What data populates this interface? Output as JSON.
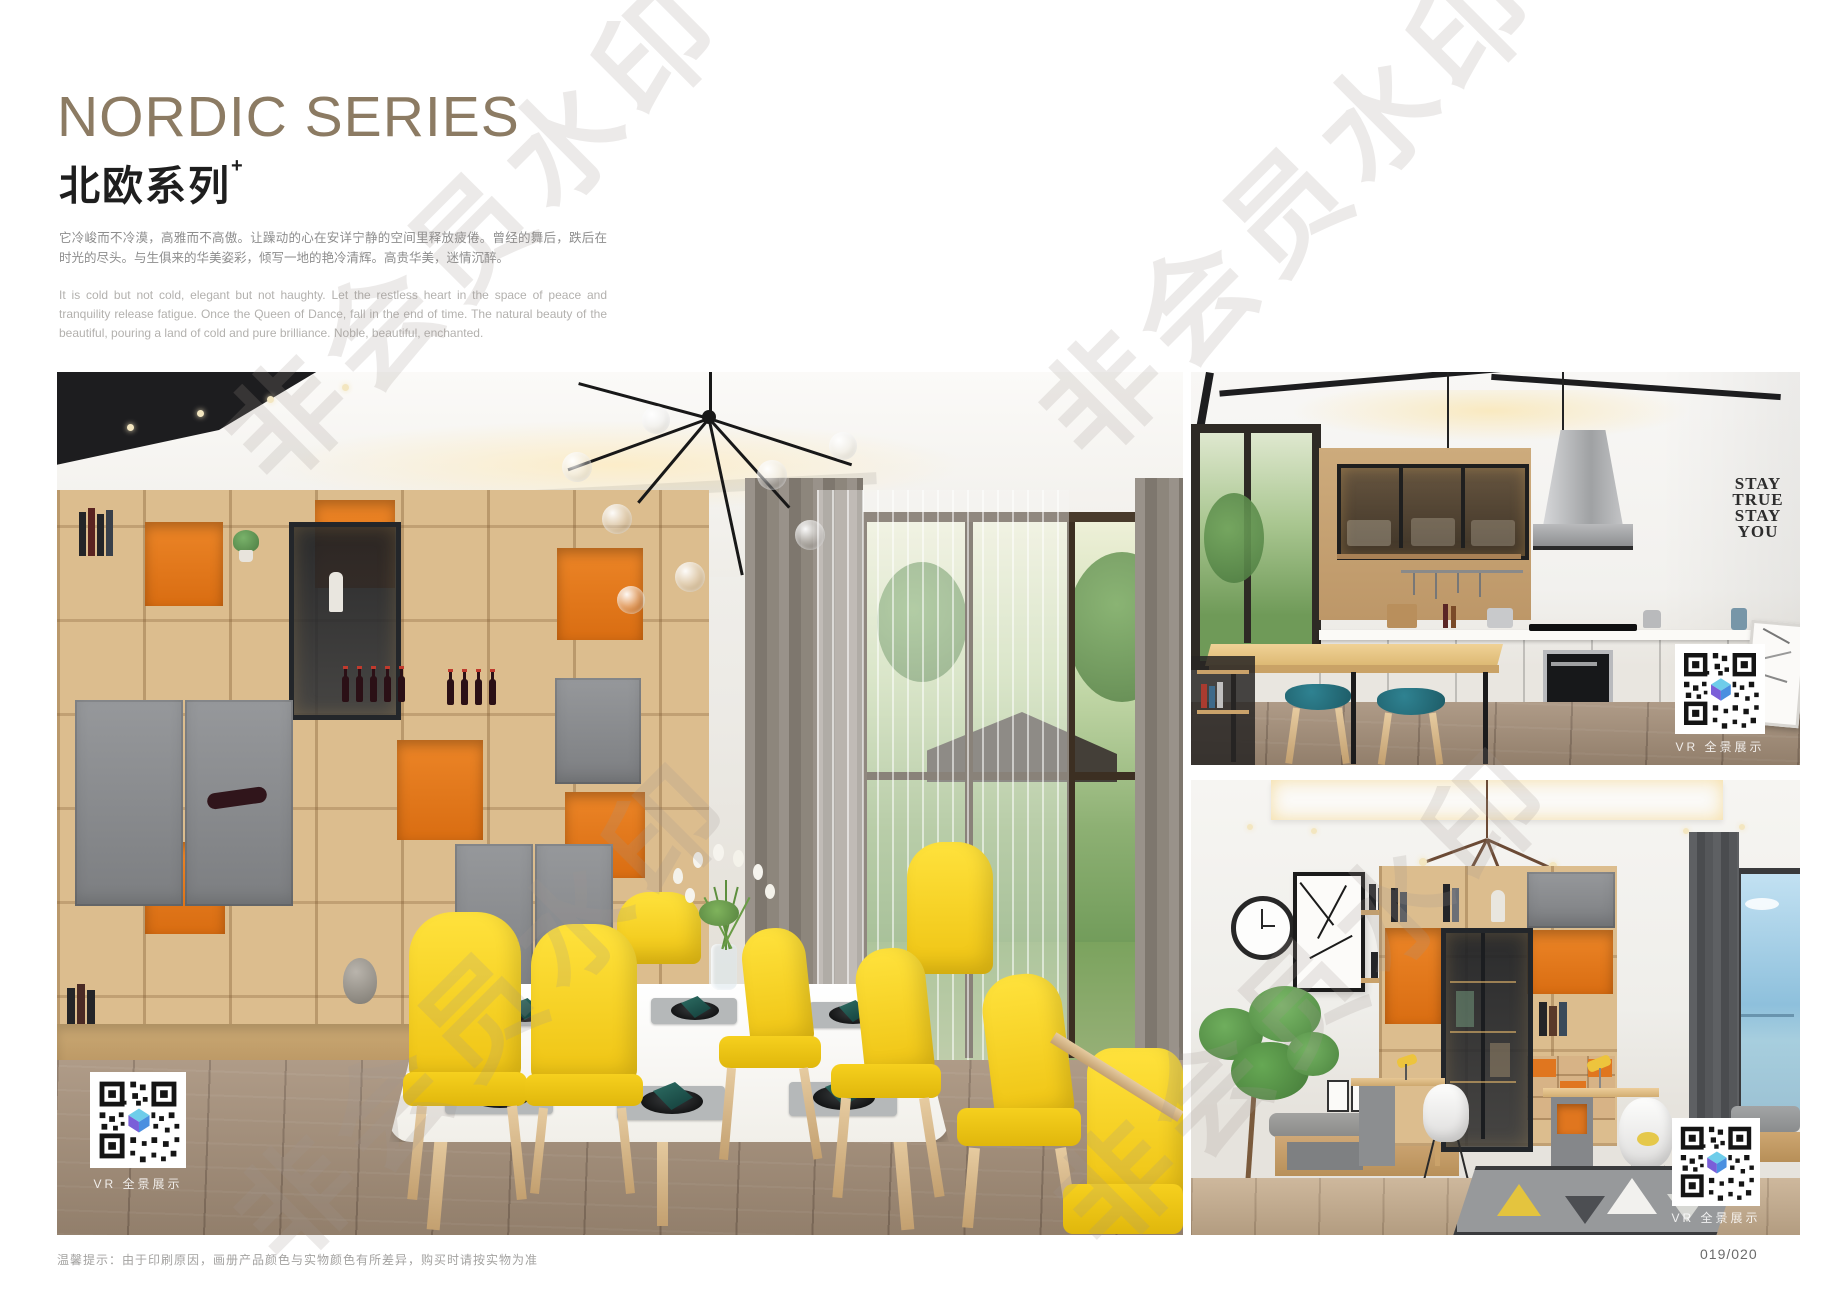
{
  "header": {
    "title": "NORDIC SERIES",
    "subtitle_cn": "北欧系列",
    "subtitle_sup": "+",
    "description_cn": "它冷峻而不冷漠，高雅而不高傲。让躁动的心在安详宁静的空间里释放疲倦。曾经的舞后，跌后在时光的尽头。与生俱来的华美姿彩，倾写一地的艳冷清辉。高贵华美，迷情沉醉。",
    "description_en": "It is cold but not cold, elegant but not haughty. Let the restless heart in the space of peace and tranquility release fatigue. Once the Queen of Dance, fall in the end of time. The natural beauty of the beautiful, pouring a land of cold and pure brilliance. Noble, beautiful, enchanted."
  },
  "watermark": {
    "text": "非会员水印"
  },
  "photos": {
    "dining": {
      "qr_label": "VR 全景展示"
    },
    "kitchen": {
      "qr_label": "VR 全景展示",
      "wall_decal": [
        "STAY",
        "TRUE",
        "STAY",
        "YOU"
      ]
    },
    "study": {
      "qr_label": "VR 全景展示"
    }
  },
  "footer": {
    "note": "温馨提示：由于印刷原因，画册产品颜色与实物颜色有所差异，购买时请按实物为准",
    "page_number": "019/020"
  },
  "colors": {
    "title_bronze": "#8c7b63",
    "chair_yellow": "#f2cc16",
    "cabinet_orange": "#e0761f",
    "cabinet_gray": "#85878a",
    "napkin_teal": "#1e5a52",
    "stool_teal": "#26707e",
    "wood_light": "#dcbd8e"
  }
}
